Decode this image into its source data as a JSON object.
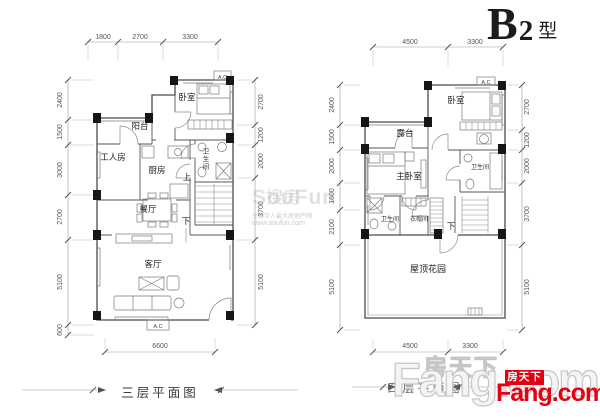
{
  "header": {
    "unit": "B",
    "unit_sub": "2",
    "type_suffix": "型"
  },
  "plan3": {
    "title": "三层平面图",
    "dims": {
      "top": [
        "1800",
        "2700",
        "3300"
      ],
      "left": [
        "2400",
        "1500",
        "3000",
        "2700",
        "5100",
        "600"
      ],
      "right": [
        "2700",
        "1200",
        "2000",
        "3700",
        "5100"
      ],
      "bottom": [
        "6600"
      ]
    },
    "rooms": {
      "bedroom": "卧室",
      "balcony": "阳台",
      "maid": "工人房",
      "kitchen": "厨房",
      "bath": "卫生间",
      "dining": "餐厅",
      "living": "客厅"
    },
    "stairs": {
      "up": "上",
      "down": "下"
    },
    "ac": "A.C"
  },
  "plan4": {
    "title": "四层平面图",
    "dims": {
      "top": [
        "4500",
        "3300"
      ],
      "left": [
        "2400",
        "1500",
        "2000",
        "1600",
        "2100",
        "5100"
      ],
      "right": [
        "2700",
        "1200",
        "2000",
        "3700",
        "5100"
      ],
      "bottom": [
        "4500",
        "3300"
      ]
    },
    "rooms": {
      "bedroom": "卧室",
      "terrace": "露台",
      "master": "主卧室",
      "bath1": "卫生间",
      "bath2": "卫生间",
      "closet": "衣帽间",
      "roof_garden": "屋顶花园"
    },
    "stairs": {
      "down": "下"
    },
    "ac": "A.C"
  },
  "watermarks": {
    "center": {
      "cn": "搜房",
      "en": "SouFun",
      "tagline": "全球华人最大房地产网",
      "url": "www.soufun.com"
    },
    "bottom_cn": "房天下",
    "bottom_en": "Fang.com",
    "logo": {
      "cn": "房天下",
      "en": "Fang.com"
    }
  },
  "colors": {
    "logo_red": "#e60012",
    "wall_line": "#4a4a4a",
    "dim_text": "#555555",
    "watermark_gray": "#c6c6c6"
  }
}
